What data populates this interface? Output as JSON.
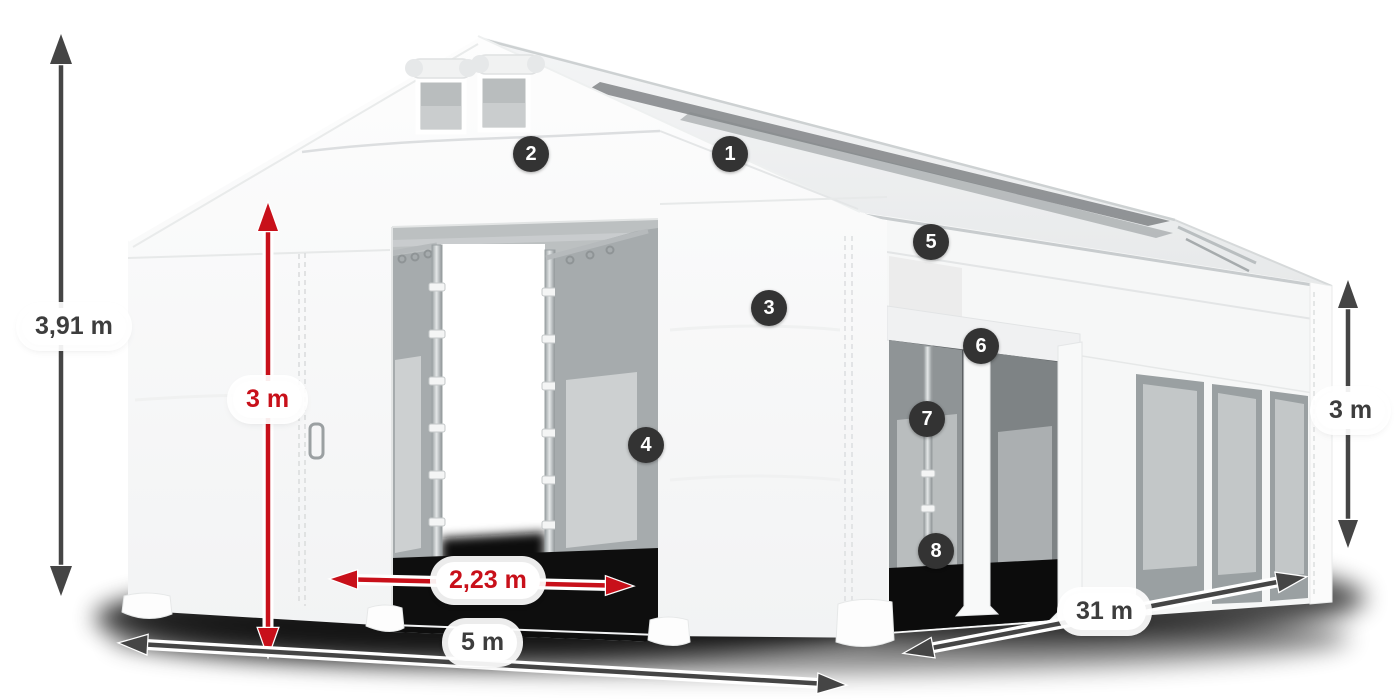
{
  "canvas": {
    "width": 1400,
    "height": 700,
    "background": "#ffffff"
  },
  "dimension_labels": {
    "total_height": "3,91 m",
    "entrance_height": "3 m",
    "entrance_width": "2,23 m",
    "front_width": "5 m",
    "side_length": "31 m",
    "side_height": "3 m"
  },
  "callouts": [
    {
      "number": "1"
    },
    {
      "number": "2"
    },
    {
      "number": "3"
    },
    {
      "number": "4"
    },
    {
      "number": "5"
    },
    {
      "number": "6"
    },
    {
      "number": "7"
    },
    {
      "number": "8"
    }
  ],
  "colors": {
    "dimension_red": "#c8101a",
    "dimension_gray": "#454545",
    "callout_background": "#333333",
    "callout_text": "#ffffff",
    "label_background": "#ffffff",
    "tent_white": "#fafbfb",
    "window_gray": "#9aa0a2"
  }
}
